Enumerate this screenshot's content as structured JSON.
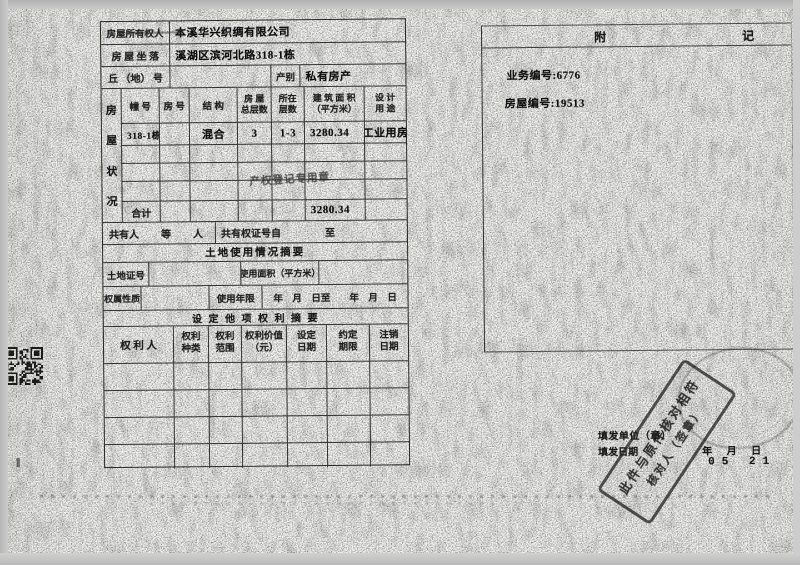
{
  "meta": {
    "owner_label": "房屋所有权人",
    "owner_value": "本溪华兴织绸有限公司",
    "location_label": "房 屋 坐 落",
    "location_value": "溪湖区滨河北路318-1栋",
    "plot_label": "丘 （地） 号",
    "category_label": "产别",
    "category_value": "私有房产"
  },
  "house": {
    "side_label_chars": [
      "房",
      "屋",
      "状",
      "况"
    ],
    "headers": {
      "unit": "幢 号",
      "room": "房 号",
      "structure": "结 构",
      "floors1": "房 屋",
      "floors2": "总层数",
      "located1": "所在",
      "located2": "层数",
      "area1": "建 筑 面 积",
      "area2": "（平方米）",
      "use1": "设 计",
      "use2": "用 途"
    },
    "data_row": {
      "unit": "318-1栋",
      "structure": "混合",
      "floors": "3",
      "located": "1-3",
      "area": "3280.34",
      "use": "工业用房"
    },
    "total_label": "合计",
    "total_area": "3280.34",
    "registry_stamp": "产权登记专用章"
  },
  "coowner": {
    "label": "共有人",
    "suffix": "等",
    "person": "人",
    "cert_label": "共有权证号自",
    "to": "至"
  },
  "land": {
    "section_title": "土地使用情况摘要",
    "cert_label": "土地证号",
    "area_label": "使用面积（平方米）",
    "nature_label": "权属性质",
    "term_label": "使用年限",
    "term_dates": "年　月　日至　　年　月　日"
  },
  "rights": {
    "section_title": "设 定 他 项 权 利 摘 要",
    "headers": {
      "holder": "权  利  人",
      "kind1": "权利",
      "kind2": "种类",
      "scope1": "权利",
      "scope2": "范围",
      "value1": "权利价值",
      "value2": "（元）",
      "set1": "设定",
      "set2": "日期",
      "term1": "约定",
      "term2": "期限",
      "cancel1": "注销",
      "cancel2": "日期"
    }
  },
  "appendix": {
    "title_left": "附",
    "title_right": "记",
    "business_no": "业务编号:6776",
    "house_no": "房屋编号:19513"
  },
  "footer": {
    "issuer_label": "填发单位（章）",
    "date_label": "填发日期",
    "date_units": "年 月 日",
    "date_value": "05 21"
  },
  "stamps": {
    "verify_line1": "此件与原件核对相符",
    "verify_line2": "核对人（签章）"
  },
  "margin_mark": "‖"
}
